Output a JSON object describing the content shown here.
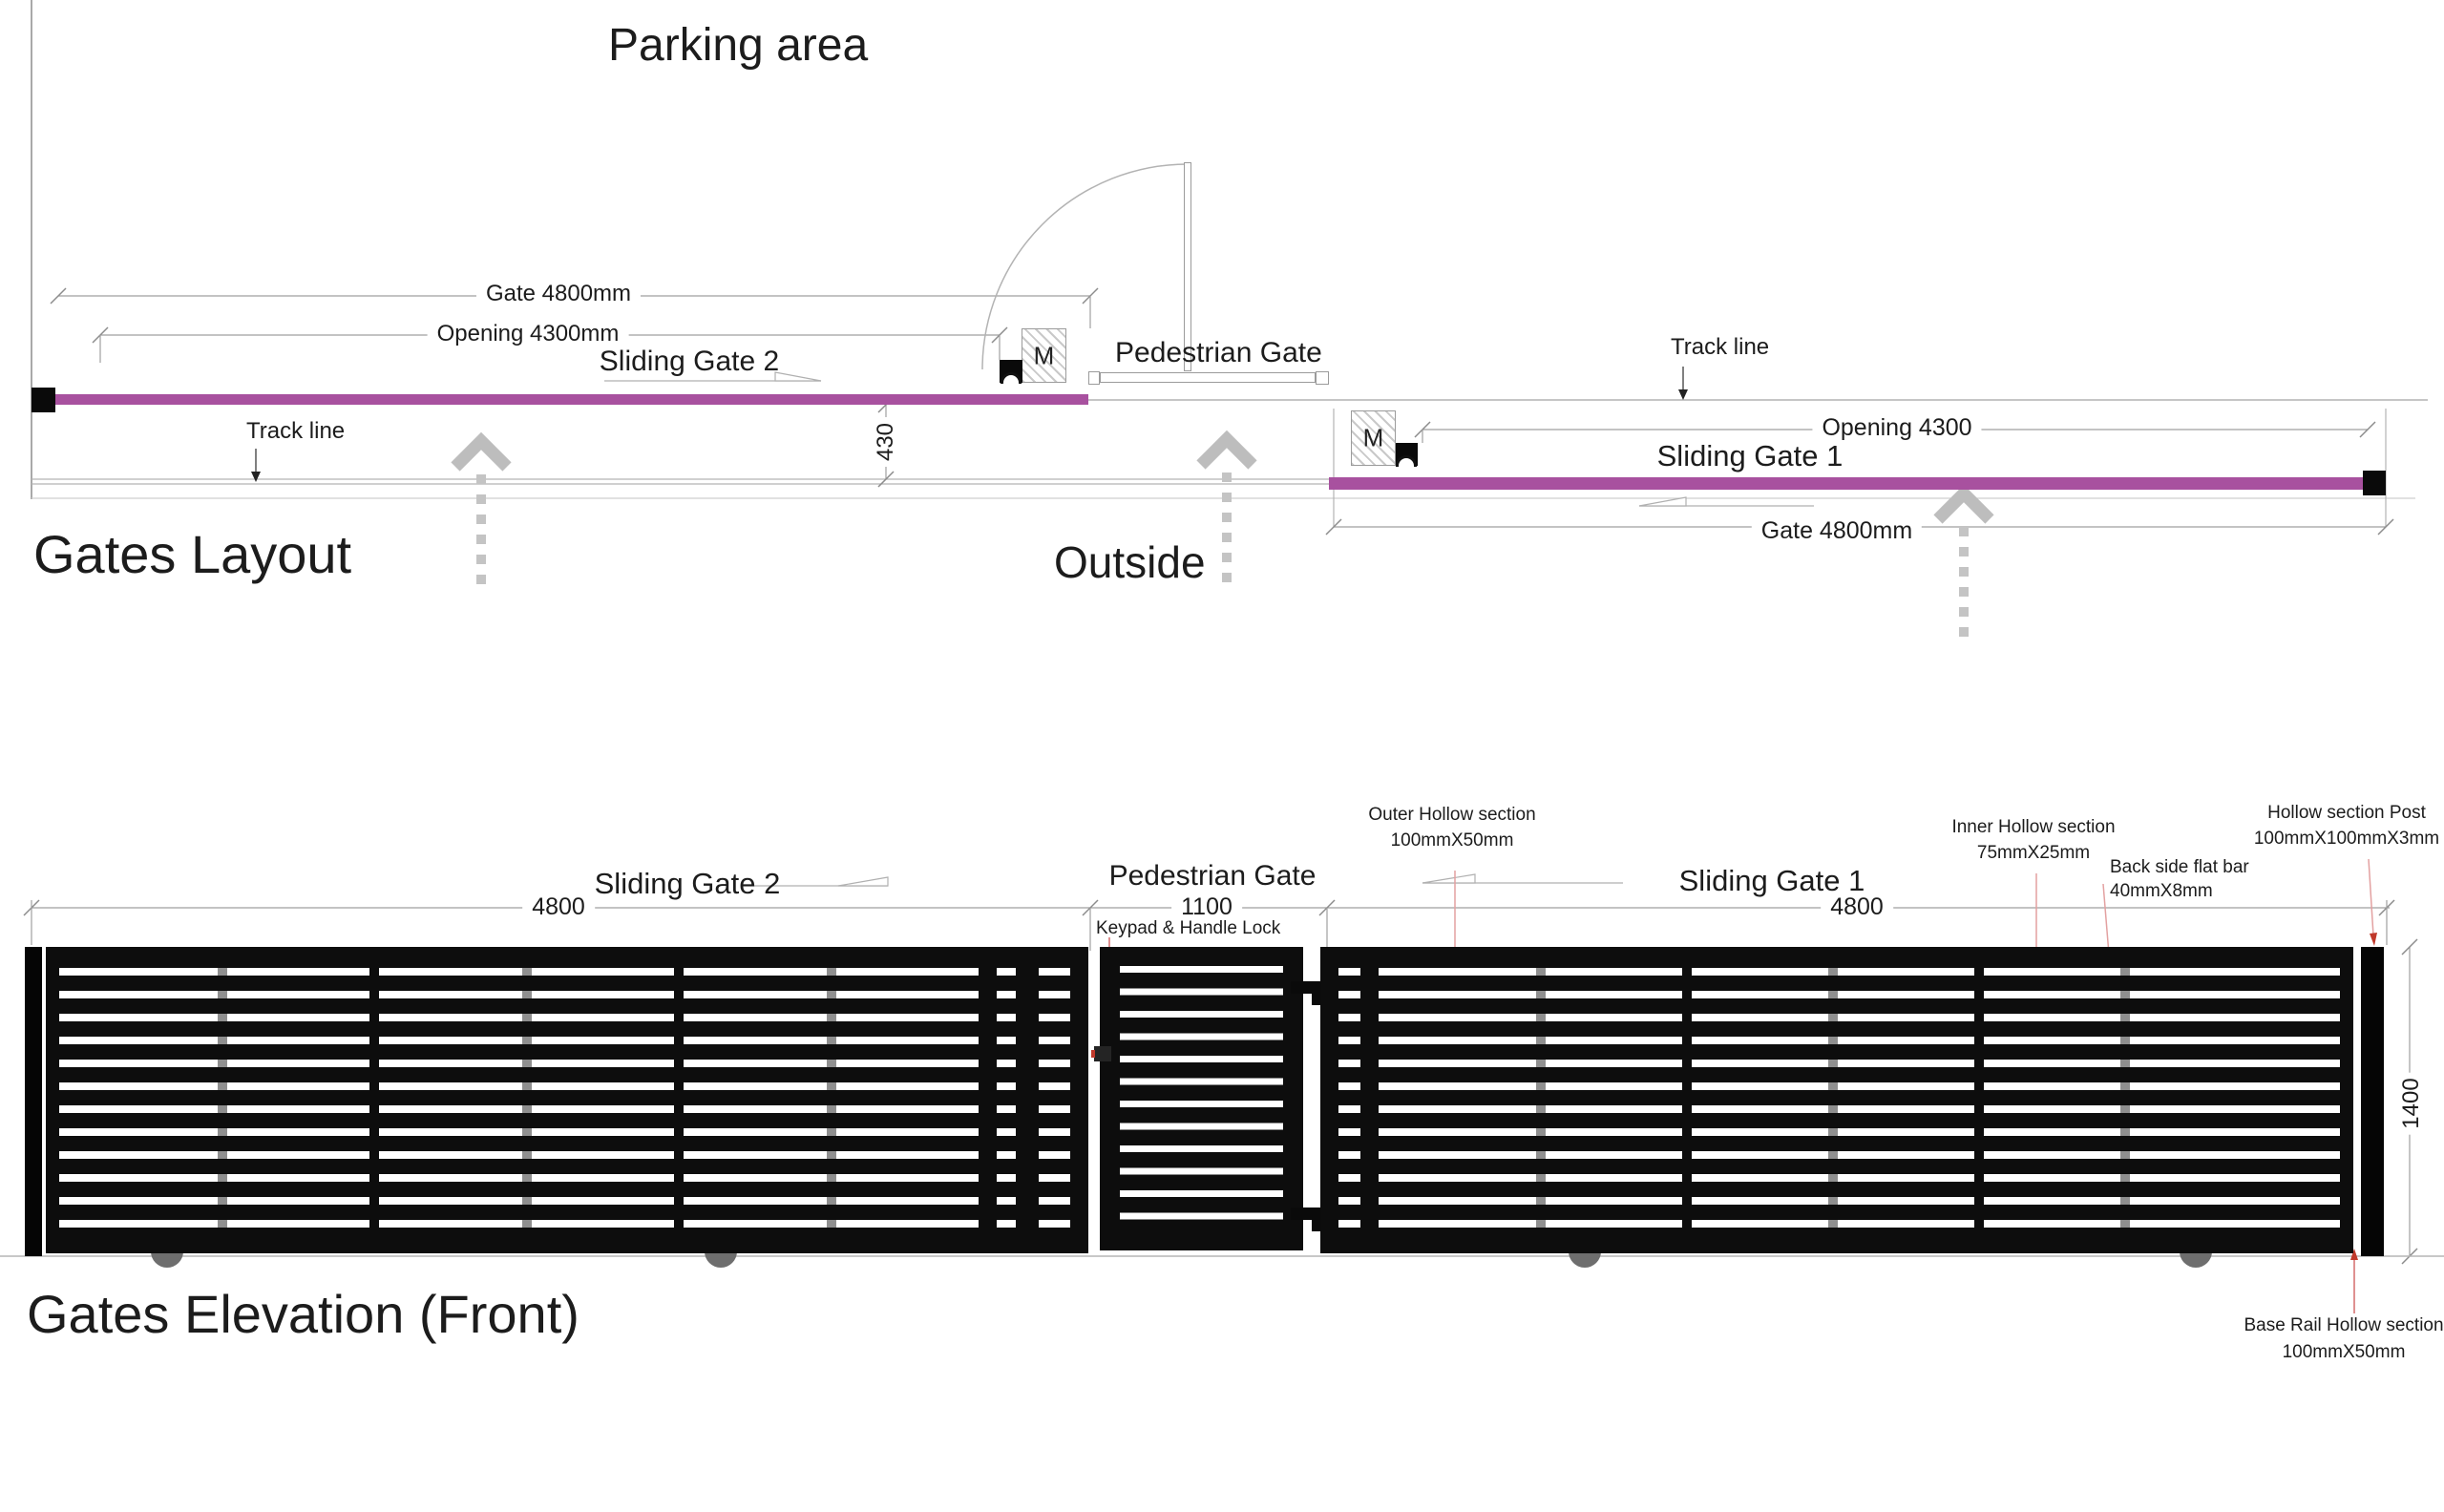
{
  "colors": {
    "gate_purple": "#A8519F",
    "gate_black": "#0d0d0d",
    "annotation_red": "#c0392b",
    "guide_gray": "#bdbdbd"
  },
  "plan": {
    "area_title": "Parking area",
    "section_title": "Gates Layout",
    "outside_label": "Outside",
    "offset_dim": "430",
    "gate2": {
      "name": "Sliding Gate 2",
      "gate_dim": "Gate 4800mm",
      "opening_dim": "Opening 4300mm",
      "motor": "M",
      "track_label": "Track line"
    },
    "pedestrian": {
      "name": "Pedestrian Gate"
    },
    "gate1": {
      "name": "Sliding Gate 1",
      "gate_dim": "Gate 4800mm",
      "opening_dim": "Opening 4300",
      "motor": "M",
      "track_label": "Track line"
    }
  },
  "elevation": {
    "section_title": "Gates Elevation (Front)",
    "height_dim": "1400",
    "gate2": {
      "name": "Sliding Gate 2",
      "width_dim": "4800"
    },
    "pedestrian": {
      "name": "Pedestrian Gate",
      "width_dim": "1100",
      "lock_label": "Keypad & Handle Lock"
    },
    "gate1": {
      "name": "Sliding Gate 1",
      "width_dim": "4800"
    },
    "annotations": {
      "outer": {
        "line1": "Outer Hollow section",
        "line2": "100mmX50mm"
      },
      "inner": {
        "line1": "Inner Hollow section",
        "line2": "75mmX25mm"
      },
      "flatbar": {
        "line1": "Back side flat bar",
        "line2": "40mmX8mm"
      },
      "post": {
        "line1": "Hollow section Post",
        "line2": "100mmX100mmX3mm"
      },
      "baserail": {
        "line1": "Base Rail Hollow section",
        "line2": "100mmX50mm"
      }
    }
  }
}
